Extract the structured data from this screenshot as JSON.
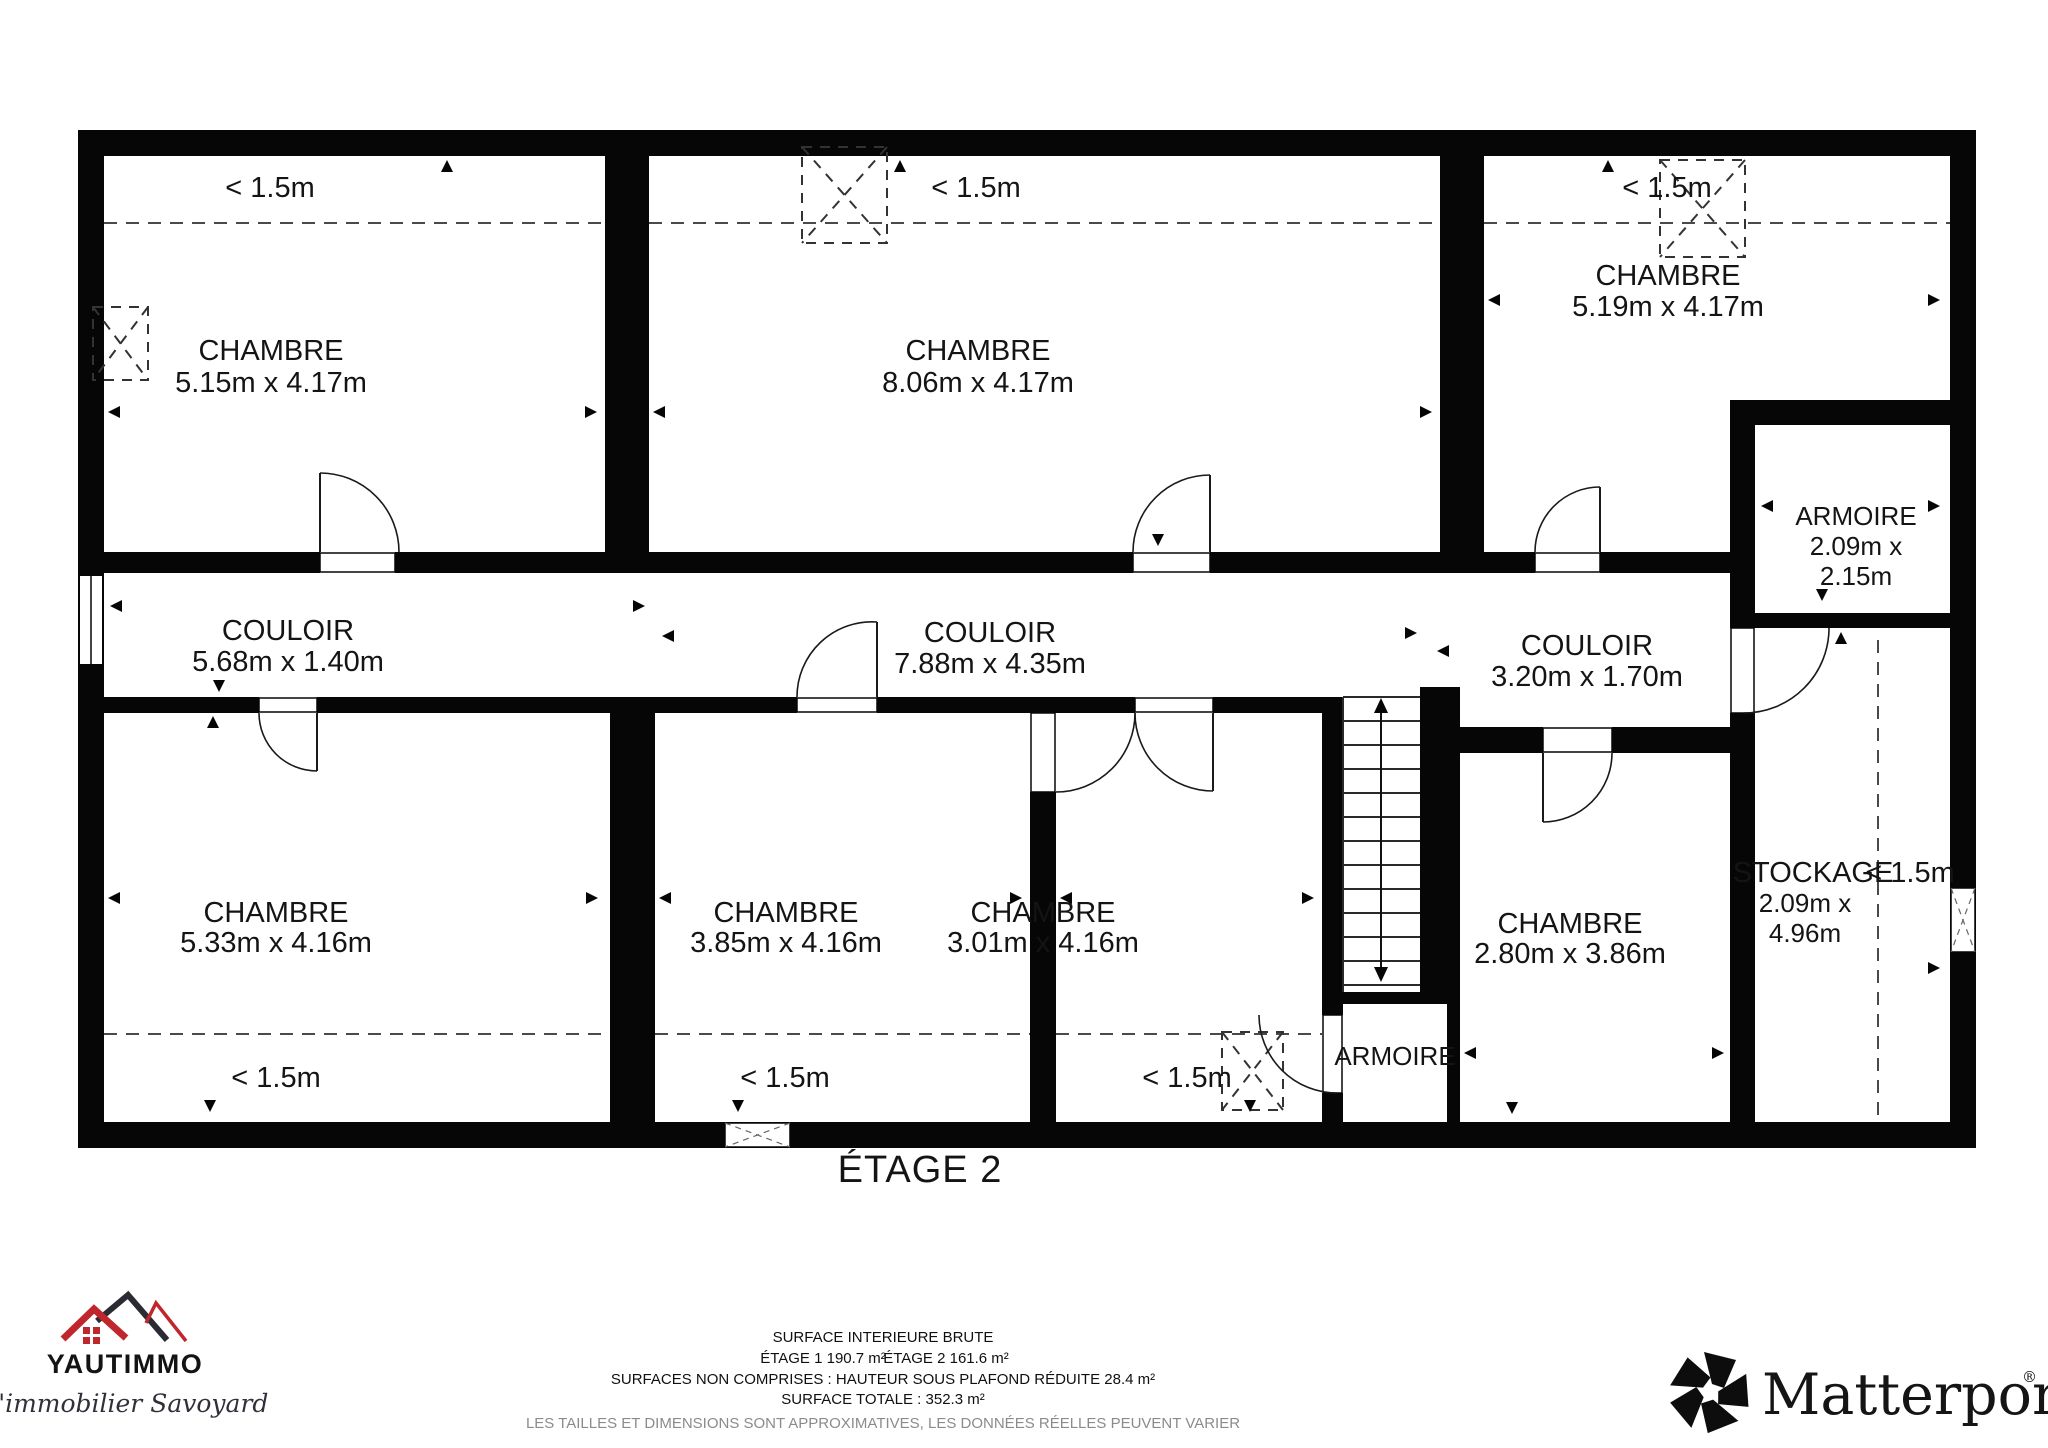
{
  "plan": {
    "floor_label": "ÉTAGE 2",
    "annotations": {
      "low_ceiling": "< 1.5m"
    },
    "rooms": {
      "chambre_top_left": {
        "label": "CHAMBRE",
        "dims": "5.15m x 4.17m"
      },
      "chambre_top_mid": {
        "label": "CHAMBRE",
        "dims": "8.06m x 4.17m"
      },
      "chambre_top_right": {
        "label": "CHAMBRE",
        "dims": "5.19m x 4.17m"
      },
      "armoire_top_right": {
        "label": "ARMOIRE",
        "dims_line1": "2.09m x",
        "dims_line2": "2.15m"
      },
      "couloir_left": {
        "label": "COULOIR",
        "dims": "5.68m x 1.40m"
      },
      "couloir_mid": {
        "label": "COULOIR",
        "dims": "7.88m x 4.35m"
      },
      "couloir_right": {
        "label": "COULOIR",
        "dims": "3.20m x 1.70m"
      },
      "chambre_bottom_left": {
        "label": "CHAMBRE",
        "dims": "5.33m x 4.16m"
      },
      "chambre_bottom_mid": {
        "label": "CHAMBRE",
        "dims": "3.85m x 4.16m"
      },
      "chambre_bottom_mid2": {
        "label": "CHAMBRE",
        "dims": "3.01m x 4.16m"
      },
      "chambre_bottom_right": {
        "label": "CHAMBRE",
        "dims": "2.80m x 3.86m"
      },
      "armoire_bottom": {
        "label": "ARMOIRE"
      },
      "stockage": {
        "label": "STOCKAGE",
        "dims_line1": "2.09m x",
        "dims_line2": "4.96m"
      }
    }
  },
  "footer": {
    "agency": {
      "name": "YAUTIMMO",
      "tagline": "L'immobilier Savoyard",
      "brand_red": "#c0272d"
    },
    "surface": {
      "title": "SURFACE INTERIEURE BRUTE",
      "etage1": "ÉTAGE 1 190.7 m²",
      "etage2": "ÉTAGE 2 161.6 m²",
      "non_comprises": "SURFACES NON COMPRISES :  HAUTEUR SOUS PLAFOND RÉDUITE 28.4 m²",
      "totale": "SURFACE TOTALE :  352.3 m²",
      "disclaimer": "LES TAILLES ET DIMENSIONS SONT APPROXIMATIVES, LES DONNÉES RÉELLES PEUVENT VARIER"
    },
    "matterport": {
      "name": "Matterport",
      "registered": "®"
    }
  }
}
